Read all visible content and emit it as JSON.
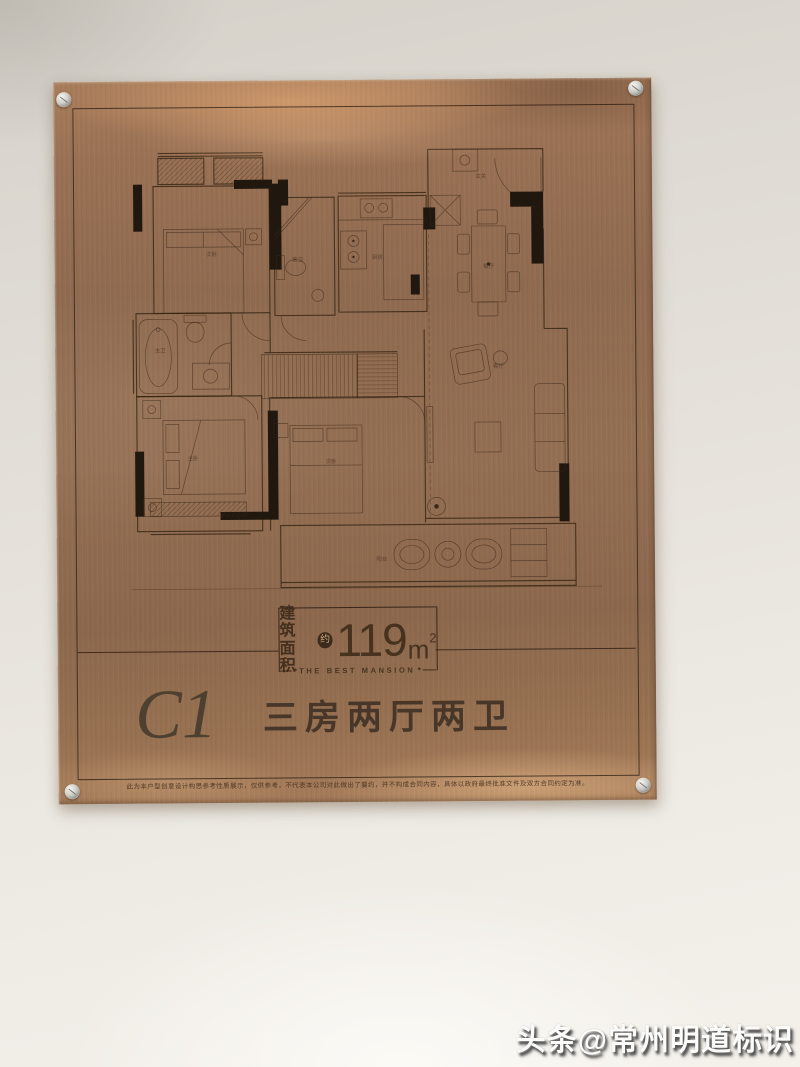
{
  "plaque": {
    "area_label_line1": "建筑",
    "area_label_line2": "面积",
    "area_badge": "约",
    "area_number": "119",
    "area_unit": "m",
    "area_exponent": "2",
    "tagline": "THE BEST MANSION",
    "tagline_bullet": "●",
    "unit_code": "C1",
    "unit_type": "三房两厅两卫",
    "disclaimer": "此为本户型创意设计构思参考性质展示，仅供参考，不代表本公司对此做出了要约，并不构成合同内容，具体以政府最终批准文件及双方合同约定为准。"
  },
  "floor_plan": {
    "room_labels": [
      {
        "text": "次卧"
      },
      {
        "text": "客卫"
      },
      {
        "text": "厨房"
      },
      {
        "text": "玄关"
      },
      {
        "text": "餐厅"
      },
      {
        "text": "主卫"
      },
      {
        "text": "主卧"
      },
      {
        "text": "次卧"
      },
      {
        "text": "客厅"
      },
      {
        "text": "阳台"
      }
    ]
  },
  "watermark": {
    "text": "头条@常州明道标识"
  },
  "colors": {
    "plaque_copper": "#946e50",
    "etch_line": "#3b2717",
    "wall_black": "#20170f",
    "text_dark": "#483729",
    "wall_bg": "#e7e3dc",
    "watermark_white": "#fbfbf9"
  }
}
